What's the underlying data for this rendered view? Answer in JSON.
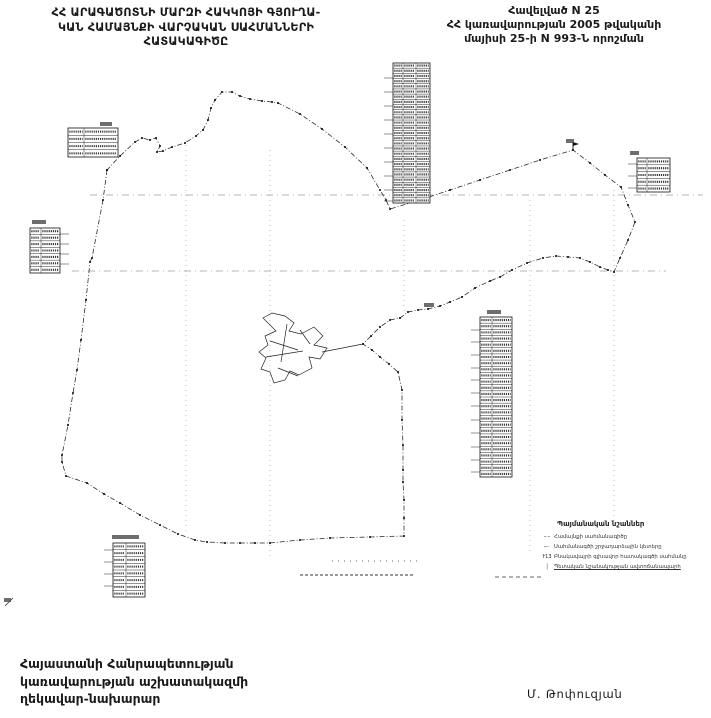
{
  "header": {
    "title_left_lines": [
      "ՀՀ ԱՐԱԳԱԾՈՏՆԻ ՄԱՐԶԻ ՀԱԿԿՈՅԻ ԳՅՈՒՂԱ-",
      "ԿԱՆ ՀԱՄԱՅՆՔԻ ՎԱՐՉԱԿԱՆ ՍԱՀՄԱՆՆԵՐԻ",
      "ՀԱՏԱԿԱԳԻԾԸ"
    ],
    "title_right_lines": [
      "Հավելված N 25",
      "ՀՀ կառավարության 2005 թվականի",
      "մայիսի 25-ի N 993-Ն որոշման"
    ]
  },
  "footer": {
    "left_lines": [
      "Հայաստանի Հանրապետության",
      "կառավարության աշխատակազմի",
      "ղեկավար-նախարար"
    ],
    "signature": "Մ. Թոփուզյան"
  },
  "legend": {
    "title": "Պայմանական նշաններ",
    "items": [
      {
        "icon": "boundary-line-sample",
        "glyph": "–·–",
        "label": "Համայնքի սահմանագիծը"
      },
      {
        "icon": "turn-point-sample",
        "glyph": "⌐·",
        "label": "Սահմանագծի շրջադարձային կետերը"
      },
      {
        "icon": "numbered-point-sample",
        "glyph": "Ւ13",
        "label": "Բնակավայրի գլխավոր հատակագծի սահմանը"
      },
      {
        "icon": "road-sample",
        "glyph": "│",
        "label": "Պետական նշանակության ավտոճանապարհ"
      }
    ]
  },
  "map": {
    "boundary_points": [
      [
        107,
        170
      ],
      [
        103,
        200
      ],
      [
        92,
        258
      ],
      [
        90,
        262
      ],
      [
        86,
        300
      ],
      [
        81,
        340
      ],
      [
        77,
        370
      ],
      [
        73,
        393
      ],
      [
        68,
        425
      ],
      [
        62,
        455
      ],
      [
        62,
        462
      ],
      [
        66,
        476
      ],
      [
        87,
        483
      ],
      [
        104,
        494
      ],
      [
        120,
        503
      ],
      [
        140,
        515
      ],
      [
        160,
        525
      ],
      [
        178,
        534
      ],
      [
        195,
        540
      ],
      [
        207,
        542
      ],
      [
        225,
        543
      ],
      [
        240,
        543
      ],
      [
        255,
        543
      ],
      [
        270,
        543
      ],
      [
        300,
        540
      ],
      [
        330,
        538
      ],
      [
        370,
        537
      ],
      [
        404,
        536
      ],
      [
        404,
        518
      ],
      [
        404,
        500
      ],
      [
        403,
        482
      ],
      [
        403,
        470
      ],
      [
        403,
        445
      ],
      [
        402,
        420
      ],
      [
        402,
        390
      ],
      [
        398,
        372
      ],
      [
        389,
        364
      ],
      [
        380,
        357
      ],
      [
        372,
        350
      ],
      [
        363,
        344
      ],
      [
        371,
        336
      ],
      [
        380,
        327
      ],
      [
        390,
        320
      ],
      [
        400,
        318
      ],
      [
        408,
        312
      ],
      [
        418,
        310
      ],
      [
        428,
        309
      ],
      [
        440,
        306
      ],
      [
        450,
        302
      ],
      [
        462,
        297
      ],
      [
        475,
        288
      ],
      [
        490,
        281
      ],
      [
        500,
        277
      ],
      [
        512,
        270
      ],
      [
        527,
        263
      ],
      [
        543,
        258
      ],
      [
        556,
        256
      ],
      [
        568,
        257
      ],
      [
        580,
        258
      ],
      [
        590,
        262
      ],
      [
        600,
        267
      ],
      [
        608,
        270
      ],
      [
        614,
        272
      ],
      [
        620,
        258
      ],
      [
        628,
        240
      ],
      [
        635,
        222
      ],
      [
        628,
        205
      ],
      [
        621,
        187
      ],
      [
        605,
        175
      ],
      [
        590,
        163
      ],
      [
        573,
        150
      ],
      [
        540,
        160
      ],
      [
        510,
        170
      ],
      [
        480,
        180
      ],
      [
        450,
        190
      ],
      [
        420,
        200
      ],
      [
        390,
        209
      ],
      [
        386,
        200
      ],
      [
        380,
        190
      ],
      [
        367,
        168
      ],
      [
        345,
        147
      ],
      [
        322,
        129
      ],
      [
        300,
        114
      ],
      [
        278,
        103
      ],
      [
        272,
        102
      ],
      [
        262,
        101
      ],
      [
        250,
        99
      ],
      [
        240,
        96
      ],
      [
        232,
        92
      ],
      [
        222,
        92
      ],
      [
        215,
        100
      ],
      [
        211,
        108
      ],
      [
        208,
        120
      ],
      [
        203,
        130
      ],
      [
        196,
        136
      ],
      [
        185,
        143
      ],
      [
        172,
        147
      ],
      [
        163,
        151
      ],
      [
        157,
        152
      ],
      [
        160,
        146
      ],
      [
        156,
        138
      ],
      [
        150,
        140
      ],
      [
        142,
        138
      ],
      [
        135,
        142
      ],
      [
        120,
        156
      ],
      [
        107,
        170
      ]
    ],
    "village_path": "M 263 318 l 9 -5 l 13 3 l 9 7 l -5 8 l 12 3 l 13 -7 l 9 9 l -9 9 l 13 3 l -7 11 l -11 -2 l 3 11 l -13 7 l -9 -4 l -5 9 l -11 3 l -4 -11 l -9 -3 l 5 -11 l -7 -6 l 9 -7 l -3 -9 l 11 -5 z M 270 341 l 28 9 M 287 324 l -6 38 M 266 357 l 37 -6 M 322 352 L 363 344 M 300 330 l 10 14 M 278 368 l 20 8",
    "graticule": {
      "verticals": [
        {
          "x": 186,
          "y1": 140,
          "y2": 535
        },
        {
          "x": 270,
          "y1": 150,
          "y2": 560
        },
        {
          "x": 404,
          "y1": 220,
          "y2": 312
        },
        {
          "x": 530,
          "y1": 200,
          "y2": 555
        },
        {
          "x": 614,
          "y1": 190,
          "y2": 530
        }
      ],
      "horizontals": [
        {
          "y": 195,
          "x1": 90,
          "x2": 703
        },
        {
          "y": 271,
          "x1": 72,
          "x2": 666
        }
      ]
    },
    "extra_dashes": [
      {
        "x1": 300,
        "y1": 575,
        "x2": 413,
        "y2": 575,
        "d": "3 2",
        "w": 0.9
      },
      {
        "x1": 332,
        "y1": 561,
        "x2": 420,
        "y2": 561,
        "d": "1 5",
        "w": 0.8
      },
      {
        "x1": 495,
        "y1": 577,
        "x2": 541,
        "y2": 577,
        "d": "4 3",
        "w": 0.8
      },
      {
        "x1": 5,
        "y1": 606,
        "x2": 13,
        "y2": 598,
        "d": "",
        "w": 0.8
      }
    ],
    "smudges": [
      {
        "x": 100,
        "y": 122,
        "w": 12,
        "h": 4
      },
      {
        "x": 32,
        "y": 220,
        "w": 14,
        "h": 4
      },
      {
        "x": 630,
        "y": 151,
        "w": 9,
        "h": 4
      },
      {
        "x": 487,
        "y": 310,
        "w": 14,
        "h": 4
      },
      {
        "x": 112,
        "y": 535,
        "w": 27,
        "h": 4
      },
      {
        "x": 424,
        "y": 303,
        "w": 10,
        "h": 4
      },
      {
        "x": 566,
        "y": 139,
        "w": 8,
        "h": 4
      },
      {
        "x": 4,
        "y": 598,
        "w": 7,
        "h": 4
      }
    ],
    "tables": [
      {
        "x": 393,
        "y": 63,
        "w": 37,
        "h": 140,
        "rows": 27,
        "cols": [
          10,
          23
        ],
        "leaders": {
          "side": "left",
          "ys": [
            78,
            92,
            106,
            120,
            134,
            148,
            162,
            176,
            190,
            201
          ]
        }
      },
      {
        "x": 68,
        "y": 128,
        "w": 50,
        "h": 29,
        "rows": 4,
        "cols": [
          16
        ]
      },
      {
        "x": 30,
        "y": 228,
        "w": 30,
        "h": 45,
        "rows": 7,
        "cols": [
          11
        ],
        "leaders": {
          "side": "right",
          "ys": [
            234,
            244,
            254,
            264
          ]
        }
      },
      {
        "x": 637,
        "y": 158,
        "w": 33,
        "h": 34,
        "rows": 5,
        "cols": [
          10
        ],
        "leaders": {
          "side": "left",
          "ys": [
            164,
            176,
            188
          ]
        }
      },
      {
        "x": 480,
        "y": 317,
        "w": 32,
        "h": 160,
        "rows": 26,
        "cols": [
          12
        ],
        "leaders": {
          "side": "left",
          "ys": [
            330,
            342,
            355,
            368,
            380,
            393,
            406,
            420,
            433,
            447,
            460,
            472
          ]
        }
      },
      {
        "x": 113,
        "y": 543,
        "w": 32,
        "h": 54,
        "rows": 8,
        "cols": [
          13
        ],
        "leaders": {
          "side": "left",
          "ys": [
            550,
            562,
            574,
            586
          ]
        }
      }
    ],
    "flags": [
      [
        573,
        150
      ]
    ]
  }
}
